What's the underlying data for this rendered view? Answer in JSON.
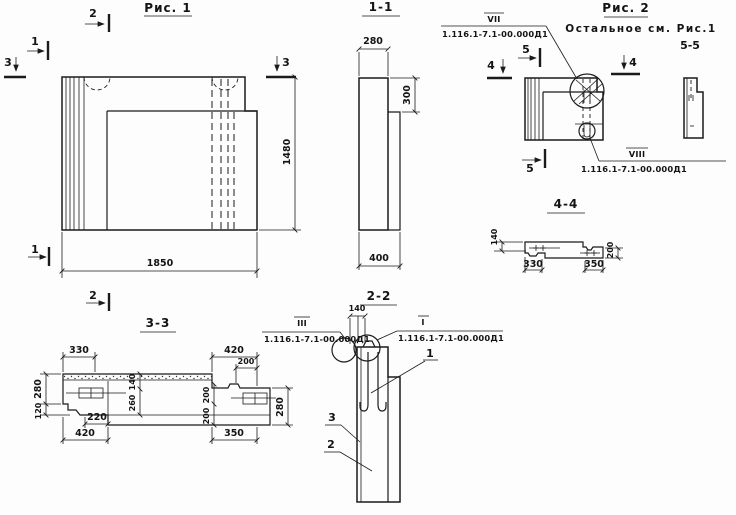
{
  "drawing": {
    "ink_color": "#1b1b1b",
    "bg_color": "#fdfdfd"
  },
  "fig1": {
    "title": "Рис. 1",
    "dim_width": "1850",
    "dim_height": "1480",
    "markers": {
      "top2": "2",
      "left1": "1",
      "left3": "3",
      "right3": "3",
      "bottom1": "1",
      "bottom2": "2"
    }
  },
  "sec11": {
    "title": "1-1",
    "dim_top": "280",
    "dim_step": "300",
    "dim_bottom": "400"
  },
  "fig2": {
    "title": "Рис. 2",
    "note": "Остальное см. Рис.1",
    "view_label": "5-5",
    "callout_vii": {
      "label": "VII",
      "doc": "1.116.1-7.1-00.000Д1"
    },
    "callout_viii": {
      "label": "VIII",
      "doc": "1.116.1-7.1-00.000Д1"
    },
    "markers": {
      "top5": "5",
      "left4": "4",
      "right4": "4",
      "bottom5": "5"
    }
  },
  "sec44": {
    "title": "4-4",
    "dim_left": "140",
    "dim_right": "200",
    "dim_bottom_left": "330",
    "dim_bottom_right": "350"
  },
  "sec33": {
    "title": "3-3",
    "dim_top_left": "330",
    "dim_top_right": "420",
    "dim_top_right_inner": "200",
    "dim_left_upper": "280",
    "dim_left_lower": "120",
    "dim_mid_upper": "140",
    "dim_mid_lower": "260",
    "dim_mid2_upper": "200",
    "dim_mid2_lower": "200",
    "dim_right": "280",
    "dim_bottom_inner": "220",
    "dim_bottom_left": "420",
    "dim_bottom_right": "350"
  },
  "sec22": {
    "title": "2-2",
    "dim_top": "140",
    "callout_iii": {
      "label": "III",
      "doc": "1.116.1-7.1-00.000Д1"
    },
    "callout_i": {
      "label": "I",
      "doc": "1.116.1-7.1-00.000Д1"
    },
    "parts": {
      "p1": "1",
      "p2": "2",
      "p3": "3"
    }
  }
}
